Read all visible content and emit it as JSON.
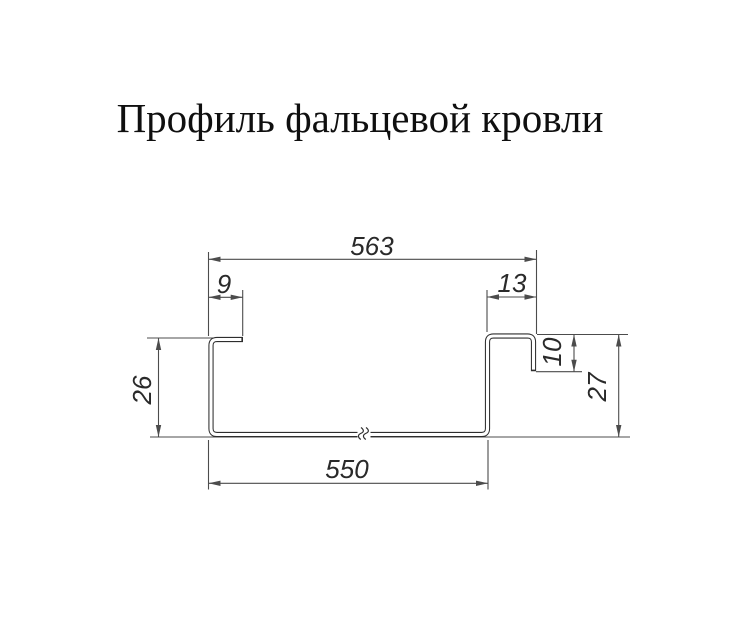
{
  "title": "Профиль фальцевой кровли",
  "drawing": {
    "type": "technical-cross-section",
    "subject": "standing-seam-roofing-profile",
    "units": "mm",
    "dimensions": {
      "overall_top_width": "563",
      "left_flange_width": "9",
      "right_flange_width": "13",
      "left_height": "26",
      "right_lip_height": "10",
      "right_height": "27",
      "bottom_width": "550"
    }
  },
  "colors": {
    "background": "#ffffff",
    "line": "#4c4c4c",
    "profile": "#2e2e2e",
    "text": "#2a2a2a",
    "title": "#0f0f0f"
  }
}
